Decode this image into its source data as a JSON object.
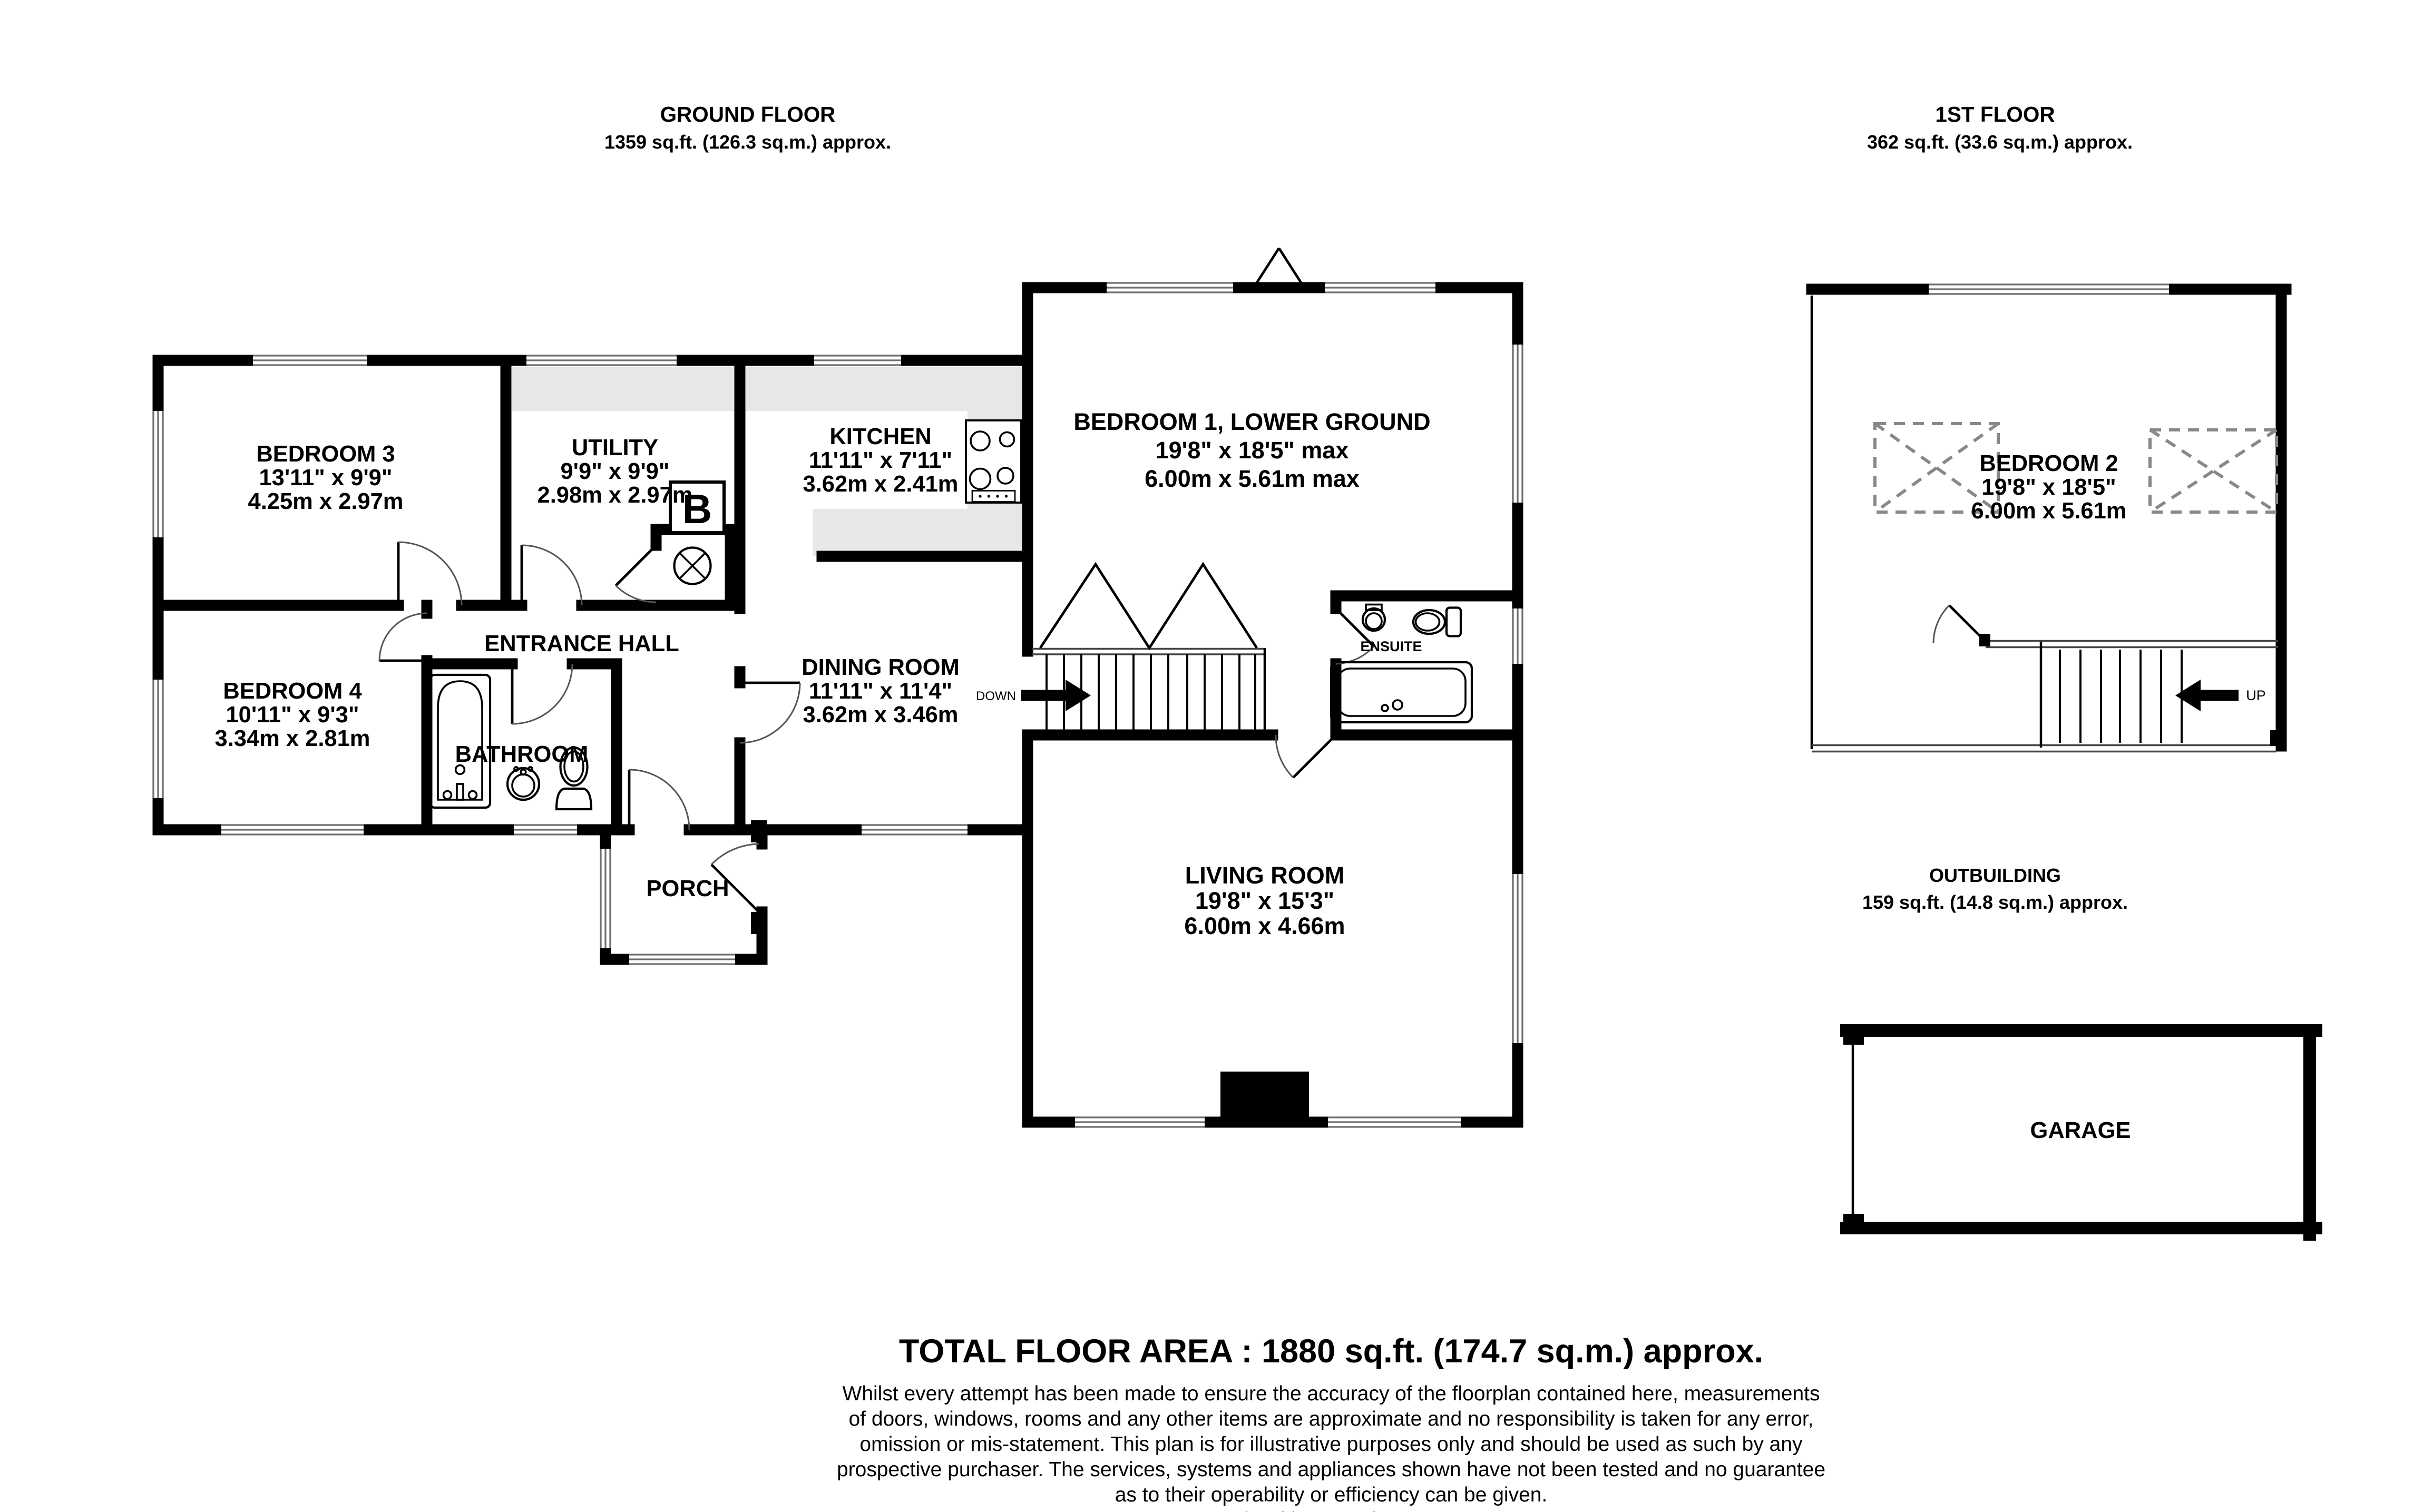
{
  "floors": {
    "ground": {
      "title": "GROUND FLOOR",
      "subtitle": "1359 sq.ft. (126.3 sq.m.) approx."
    },
    "first": {
      "title": "1ST FLOOR",
      "subtitle": "362 sq.ft. (33.6 sq.m.) approx."
    },
    "outbuilding": {
      "title": "OUTBUILDING",
      "subtitle": "159 sq.ft. (14.8 sq.m.) approx."
    }
  },
  "rooms": {
    "bedroom3": {
      "name": "BEDROOM 3",
      "imperial": "13'11\" x 9'9\"",
      "metric": "4.25m x 2.97m"
    },
    "utility": {
      "name": "UTILITY",
      "imperial": "9'9\" x 9'9\"",
      "metric": "2.98m x 2.97m"
    },
    "kitchen": {
      "name": "KITCHEN",
      "imperial": "11'11\" x 7'11\"",
      "metric": "3.62m x 2.41m"
    },
    "bedroom1": {
      "name": "BEDROOM 1, LOWER GROUND",
      "imperial": "19'8\" x 18'5\" max",
      "metric": "6.00m x 5.61m max"
    },
    "entrance_hall": {
      "name": "ENTRANCE HALL"
    },
    "bedroom4": {
      "name": "BEDROOM 4",
      "imperial": "10'11\" x 9'3\"",
      "metric": "3.34m x 2.81m"
    },
    "bathroom": {
      "name": "BATHROOM"
    },
    "dining": {
      "name": "DINING ROOM",
      "imperial": "11'11\" x 11'4\"",
      "metric": "3.62m x 3.46m"
    },
    "ensuite": {
      "name": "ENSUITE"
    },
    "living": {
      "name": "LIVING ROOM",
      "imperial": "19'8\" x 15'3\"",
      "metric": "6.00m x 4.66m"
    },
    "porch": {
      "name": "PORCH"
    },
    "bedroom2": {
      "name": "BEDROOM 2",
      "imperial": "19'8\" x 18'5\"",
      "metric": "6.00m x 5.61m"
    },
    "garage": {
      "name": "GARAGE"
    }
  },
  "labels": {
    "down": "DOWN",
    "up": "UP",
    "boiler": "B"
  },
  "footer": {
    "total": "TOTAL FLOOR AREA : 1880 sq.ft. (174.7 sq.m.) approx.",
    "disclaimer": [
      "Whilst every attempt has been made to ensure the accuracy of the floorplan contained here, measurements",
      "of doors, windows, rooms and any other items are approximate and no responsibility is taken for any error,",
      "omission or mis-statement. This plan is for illustrative purposes only and should be used as such by any",
      "prospective purchaser. The services, systems and appliances shown have not been tested and no guarantee",
      "as to their operability or efficiency can be given."
    ],
    "credit": "Made with Metropix ©2025"
  },
  "colors": {
    "wall": "#000000",
    "window_line": "#6e6e6e",
    "counter": "#e7e7e7",
    "dashed_box": "#888888",
    "background": "#ffffff"
  }
}
